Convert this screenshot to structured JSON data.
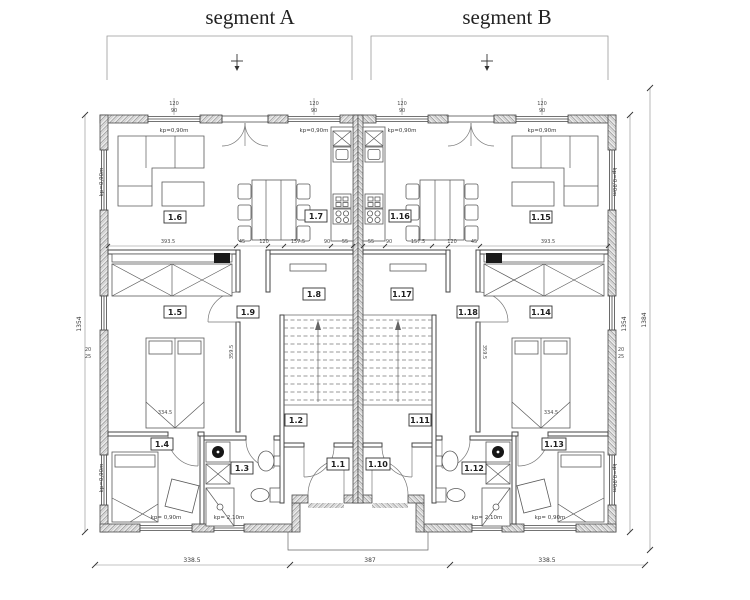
{
  "segments": {
    "a": "segment A",
    "b": "segment B"
  },
  "rooms": [
    {
      "num": "1.1"
    },
    {
      "num": "1.2"
    },
    {
      "num": "1.3"
    },
    {
      "num": "1.4"
    },
    {
      "num": "1.5"
    },
    {
      "num": "1.6"
    },
    {
      "num": "1.7"
    },
    {
      "num": "1.8"
    },
    {
      "num": "1.9"
    },
    {
      "num": "1.10"
    },
    {
      "num": "1.11"
    },
    {
      "num": "1.12"
    },
    {
      "num": "1.13"
    },
    {
      "num": "1.14"
    },
    {
      "num": "1.15"
    },
    {
      "num": "1.16"
    },
    {
      "num": "1.17"
    },
    {
      "num": "1.18"
    }
  ],
  "kp": {
    "w090": "kp=0,90m",
    "w090s": "kp= 0,90m",
    "w210": "kp= 2,10m"
  },
  "dims": {
    "bottom": [
      "338.5",
      "387",
      "338.5"
    ],
    "left_total": "1354",
    "right_inner": "1354",
    "right_outer": "1384",
    "row": [
      "393.5",
      "45",
      "120",
      "157.5",
      "90",
      "55"
    ],
    "bed": "334.5",
    "stair": "359.5",
    "win_w": "120",
    "win_h": "90",
    "note_a": "20",
    "note_b": "25"
  }
}
